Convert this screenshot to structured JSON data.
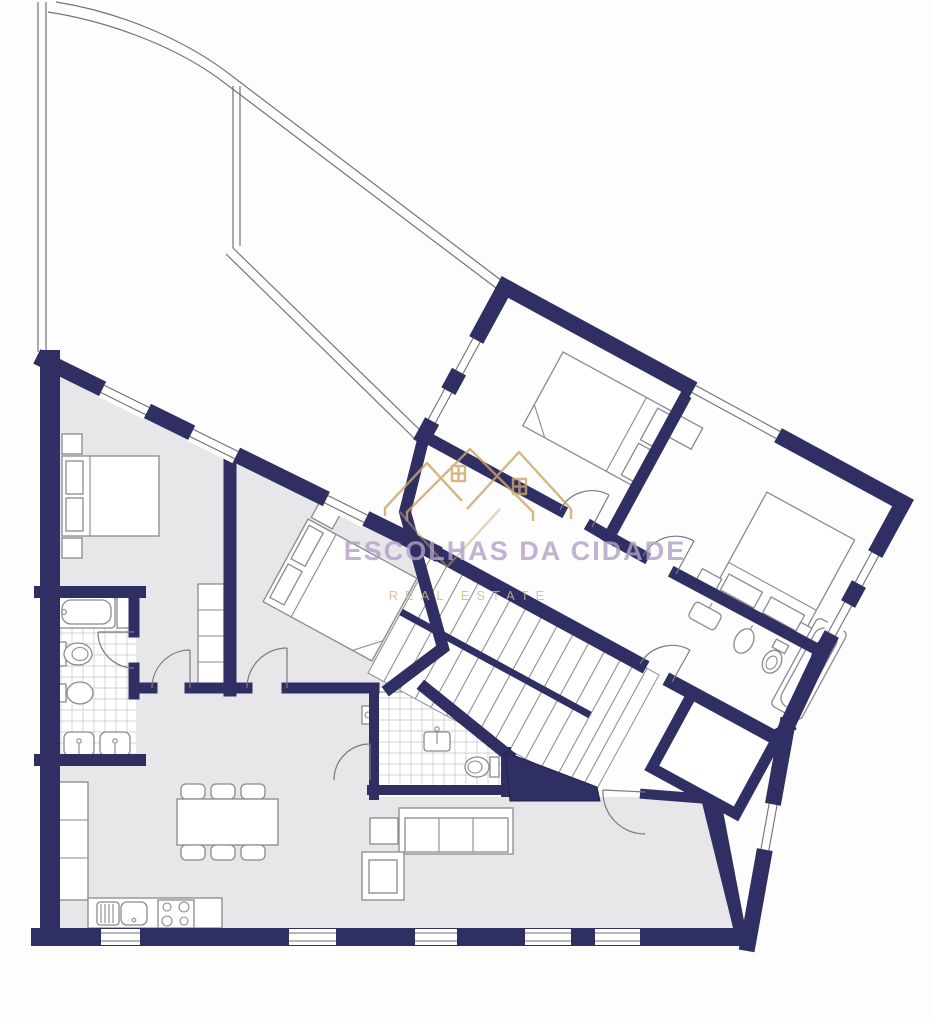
{
  "watermark": {
    "title": "ESCOLHAS DA CIDADE",
    "subtitle": "REAL ESTATE"
  },
  "colors": {
    "wall_navy": "#2f2f64",
    "floor_gray": "#e7e7e9",
    "outline_gray": "#73737a",
    "tile_gray": "#c4c4ca",
    "logo_gold": "#c9a769",
    "title_violet": "#b3a0c8",
    "background": "#fdfdfd"
  },
  "elements": {
    "furniture_icons": [
      "double-bed",
      "nightstand",
      "wardrobe",
      "bathtub",
      "toilet",
      "bidet",
      "washbasin",
      "kitchen-sink",
      "stove",
      "dining-table",
      "dining-chair",
      "sofa",
      "armchair",
      "side-table",
      "staircase",
      "closet"
    ],
    "structure": [
      "navy-wall",
      "window",
      "door-arc",
      "tiled-floor",
      "stair-treads",
      "outline-unit"
    ]
  }
}
